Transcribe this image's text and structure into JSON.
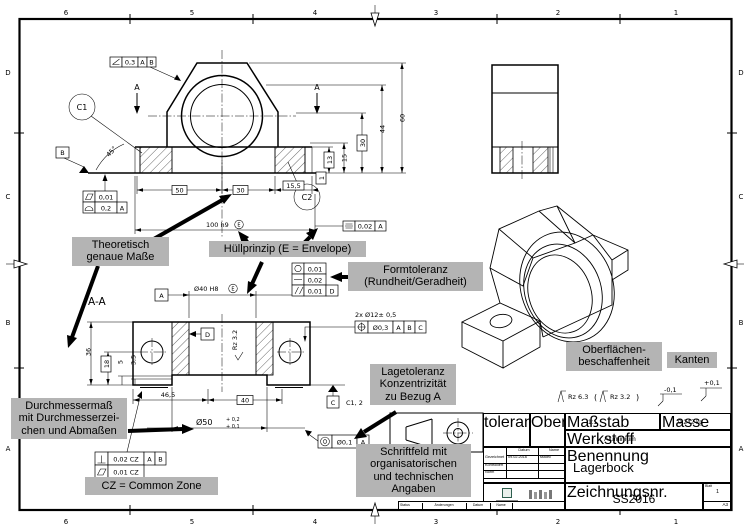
{
  "grid": {
    "cols": [
      "6",
      "5",
      "4",
      "3",
      "2",
      "1"
    ],
    "rows": [
      "D",
      "C",
      "B",
      "A"
    ]
  },
  "front": {
    "cut_label": "A",
    "dims": {
      "d50": "50",
      "d30": "30",
      "d155": "15,5",
      "d100": "100 h9",
      "env": "E",
      "d60": "60",
      "d44": "44",
      "d30v": "30",
      "d15": "15",
      "d13": "13",
      "d1": "1",
      "angle": "45°"
    },
    "frames": {
      "angularity": [
        "0,3",
        "A",
        "B"
      ],
      "flatness": "0,01",
      "profile": [
        "0,2",
        "A"
      ],
      "symmetry": [
        "0,02",
        "A"
      ]
    },
    "datums": {
      "b": "B",
      "c1": "C1",
      "c2": "C2"
    }
  },
  "section": {
    "label": "A-A",
    "dims": {
      "d36": "36",
      "d18": "18",
      "d5": "5",
      "d35": "3,5",
      "d465": "46,5",
      "d40": "40",
      "d50": "Ø50",
      "d50_up": "+ 0,2",
      "d50_lo": "+ 0,1",
      "d40b": "Ø40 H8",
      "env": "E",
      "holes": "2x Ø12± 0,5",
      "rz": "Rz 3.2"
    },
    "frames": {
      "roundness": "0,01",
      "straightness": "0,02",
      "parallelism": [
        "0,01",
        "D"
      ],
      "position": [
        "Ø0,3",
        "A",
        "B",
        "C"
      ],
      "concentricity": [
        "Ø0,1",
        "A"
      ],
      "perpendicularity": [
        "0,02 CZ",
        "A",
        "B"
      ],
      "flatness_cz": "0,01 CZ"
    },
    "datums": {
      "a": "A",
      "d": "D",
      "c": "C",
      "cnote": "C1, 2"
    }
  },
  "labels": {
    "theoretisch": "Theoretisch\ngenaue Maße",
    "huellprinzip": "Hüllprinzip (E = Envelope)",
    "formtoleranz": "Formtoleranz\n(Rundheit/Geradheit)",
    "lagetoleranz": "Lagetoleranz\nKonzentrizität\nzu Bezug A",
    "oberflaechen": "Oberflächen-\nbeschaffenheit",
    "kanten": "Kanten",
    "durchmesser": "Durchmessermaß\nmit Durchmesserzei-\nchen und Abmaßen",
    "cz": "CZ = Common Zone",
    "schriftfeld": "Schriftfeld mit\norganisatorischen\nund technischen\nAngaben"
  },
  "surface": {
    "rz1": "Rz 6.3",
    "rz2": "Rz 3.2",
    "p1": "(",
    "p2": ")",
    "edge_minus": "-0,1",
    "edge_plus": "+0,1"
  },
  "titleblock": {
    "allg1": "Allgemein-",
    "allg2": "toleranz",
    "allg3": "ISO 2768-mK",
    "obf1": "Oberfläche",
    "obf2": "ISO",
    "obf3": "1302",
    "massstab_label": "Maßstab",
    "massstab": "1:1",
    "masse_label": "Masse",
    "masse": "0,242 kg",
    "werkstoff_label": "Werkstoff",
    "werkstoff": "Aluminium",
    "benennung_label": "Benennung",
    "benennung": "Lagerbock",
    "zeichnr_label": "Zeichnungsnr.",
    "zeichnr": "SS2016",
    "blatt_label": "Blatt",
    "blatt": "1",
    "format": "A3",
    "tbl": {
      "datum_h": "Datum",
      "name_h": "Name",
      "rows": [
        [
          "Gezeichnet",
          "09.02.2016",
          "sstoec"
        ],
        [
          "Kontrolliert",
          "",
          ""
        ],
        [
          "Norm",
          "",
          ""
        ]
      ]
    },
    "bottom": [
      "Status",
      "Änderungen",
      "Datum",
      "Name"
    ]
  }
}
